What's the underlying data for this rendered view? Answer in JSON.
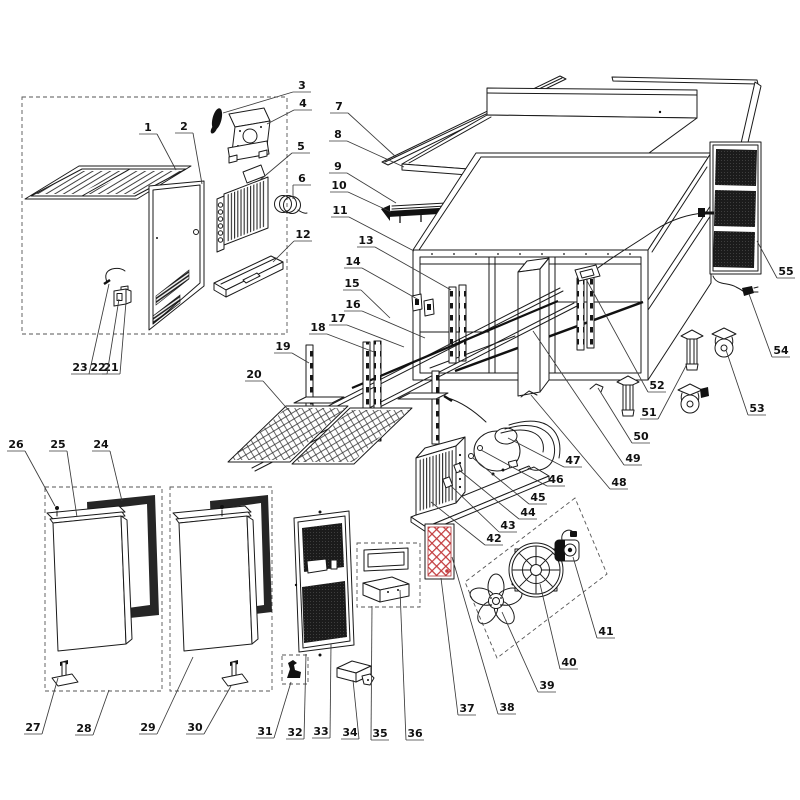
{
  "diagram": {
    "kind": "exploded-parts-diagram",
    "colors": {
      "line": "#1a1a1a",
      "accent_red": "#c23b3d",
      "mesh_dark": "#1b1b1b",
      "background": "#ffffff"
    },
    "labels": [
      {
        "n": "1",
        "x": 148,
        "y": 127,
        "tx": 176,
        "ty": 170
      },
      {
        "n": "2",
        "x": 184,
        "y": 126,
        "tx": 202,
        "ty": 184
      },
      {
        "n": "3",
        "x": 302,
        "y": 85,
        "tx": 223,
        "ty": 113
      },
      {
        "n": "4",
        "x": 303,
        "y": 103,
        "tx": 267,
        "ty": 124
      },
      {
        "n": "5",
        "x": 301,
        "y": 146,
        "tx": 260,
        "ty": 180
      },
      {
        "n": "6",
        "x": 302,
        "y": 178,
        "tx": 293,
        "ty": 199
      },
      {
        "n": "7",
        "x": 339,
        "y": 106,
        "tx": 396,
        "ty": 157
      },
      {
        "n": "8",
        "x": 338,
        "y": 134,
        "tx": 404,
        "ty": 167
      },
      {
        "n": "9",
        "x": 338,
        "y": 166,
        "tx": 396,
        "ty": 203
      },
      {
        "n": "10",
        "x": 339,
        "y": 185,
        "tx": 391,
        "ty": 212
      },
      {
        "n": "11",
        "x": 340,
        "y": 210,
        "tx": 414,
        "ty": 251
      },
      {
        "n": "12",
        "x": 303,
        "y": 234,
        "tx": 273,
        "ty": 262
      },
      {
        "n": "13",
        "x": 366,
        "y": 240,
        "tx": 451,
        "ty": 290
      },
      {
        "n": "14",
        "x": 353,
        "y": 261,
        "tx": 419,
        "ty": 300
      },
      {
        "n": "15",
        "x": 352,
        "y": 283,
        "tx": 390,
        "ty": 318
      },
      {
        "n": "16",
        "x": 353,
        "y": 304,
        "tx": 425,
        "ty": 338
      },
      {
        "n": "17",
        "x": 338,
        "y": 318,
        "tx": 404,
        "ty": 347
      },
      {
        "n": "18",
        "x": 318,
        "y": 327,
        "tx": 374,
        "ty": 352
      },
      {
        "n": "19",
        "x": 283,
        "y": 346,
        "tx": 309,
        "ty": 363
      },
      {
        "n": "20",
        "x": 254,
        "y": 374,
        "tx": 291,
        "ty": 413
      },
      {
        "n": "21",
        "x": 111,
        "y": 367,
        "tx": 126,
        "ty": 302
      },
      {
        "n": "22",
        "x": 98,
        "y": 367,
        "tx": 119,
        "ty": 299
      },
      {
        "n": "23",
        "x": 80,
        "y": 367,
        "tx": 109,
        "ty": 284
      },
      {
        "n": "24",
        "x": 101,
        "y": 444,
        "tx": 122,
        "ty": 501
      },
      {
        "n": "25",
        "x": 58,
        "y": 444,
        "tx": 77,
        "ty": 517
      },
      {
        "n": "26",
        "x": 16,
        "y": 444,
        "tx": 55,
        "ty": 506
      },
      {
        "n": "27",
        "x": 33,
        "y": 727,
        "tx": 58,
        "ty": 678
      },
      {
        "n": "28",
        "x": 84,
        "y": 728,
        "tx": 109,
        "ty": 690
      },
      {
        "n": "29",
        "x": 148,
        "y": 727,
        "tx": 193,
        "ty": 657
      },
      {
        "n": "30",
        "x": 195,
        "y": 727,
        "tx": 231,
        "ty": 686
      },
      {
        "n": "31",
        "x": 265,
        "y": 731,
        "tx": 291,
        "ty": 682
      },
      {
        "n": "32",
        "x": 295,
        "y": 732,
        "tx": 306,
        "ty": 654
      },
      {
        "n": "33",
        "x": 321,
        "y": 731,
        "tx": 331,
        "ty": 644
      },
      {
        "n": "34",
        "x": 350,
        "y": 732,
        "tx": 353,
        "ty": 680
      },
      {
        "n": "35",
        "x": 380,
        "y": 733,
        "tx": 372,
        "ty": 606
      },
      {
        "n": "36",
        "x": 415,
        "y": 733,
        "tx": 400,
        "ty": 590
      },
      {
        "n": "37",
        "x": 467,
        "y": 708,
        "tx": 441,
        "ty": 578
      },
      {
        "n": "38",
        "x": 507,
        "y": 707,
        "tx": 452,
        "ty": 557
      },
      {
        "n": "39",
        "x": 547,
        "y": 685,
        "tx": 502,
        "ty": 612
      },
      {
        "n": "40",
        "x": 569,
        "y": 662,
        "tx": 540,
        "ty": 584
      },
      {
        "n": "41",
        "x": 606,
        "y": 631,
        "tx": 573,
        "ty": 557
      },
      {
        "n": "42",
        "x": 494,
        "y": 538,
        "tx": 431,
        "ty": 502
      },
      {
        "n": "43",
        "x": 508,
        "y": 525,
        "tx": 450,
        "ty": 485
      },
      {
        "n": "44",
        "x": 528,
        "y": 512,
        "tx": 459,
        "ty": 470
      },
      {
        "n": "45",
        "x": 538,
        "y": 497,
        "tx": 473,
        "ty": 458
      },
      {
        "n": "46",
        "x": 556,
        "y": 479,
        "tx": 481,
        "ty": 450
      },
      {
        "n": "47",
        "x": 573,
        "y": 460,
        "tx": 508,
        "ty": 438
      },
      {
        "n": "48",
        "x": 619,
        "y": 482,
        "tx": 531,
        "ty": 395
      },
      {
        "n": "49",
        "x": 633,
        "y": 458,
        "tx": 533,
        "ty": 331
      },
      {
        "n": "50",
        "x": 641,
        "y": 436,
        "tx": 598,
        "ty": 388
      },
      {
        "n": "51",
        "x": 649,
        "y": 412,
        "tx": 687,
        "ty": 364
      },
      {
        "n": "52",
        "x": 657,
        "y": 385,
        "tx": 586,
        "ty": 279
      },
      {
        "n": "53",
        "x": 757,
        "y": 408,
        "tx": 726,
        "ty": 350
      },
      {
        "n": "54",
        "x": 781,
        "y": 350,
        "tx": 749,
        "ty": 294
      },
      {
        "n": "55",
        "x": 786,
        "y": 271,
        "tx": 757,
        "ty": 241
      }
    ]
  }
}
